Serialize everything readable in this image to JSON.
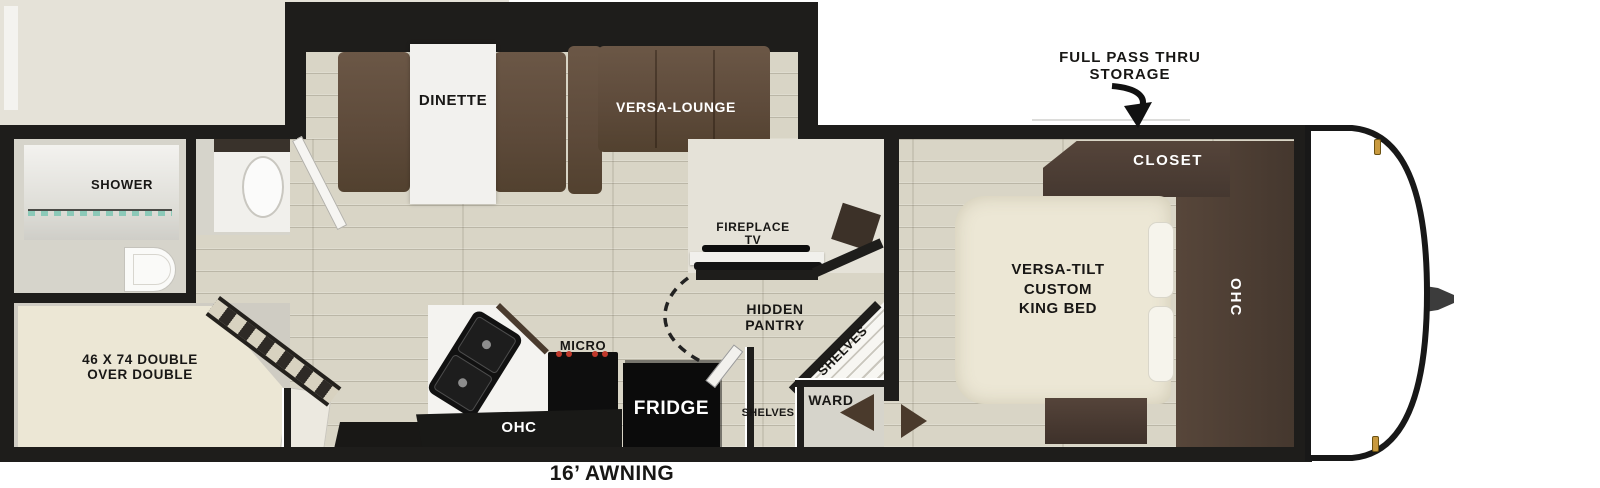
{
  "exterior": {
    "storage_callout_line1": "FULL PASS THRU",
    "storage_callout_line2": "STORAGE",
    "awning": "16’ AWNING"
  },
  "slideout": {
    "dinette": "DINETTE",
    "lounge": "VERSA-LOUNGE"
  },
  "living": {
    "fireplace_line1": "FIREPLACE",
    "fireplace_line2": "TV",
    "pantry_line1": "HIDDEN",
    "pantry_line2": "PANTRY",
    "corner_shelves": "SHELVES",
    "aisle_shelves": "SHELVES",
    "ward": "WARD"
  },
  "kitchen": {
    "micro": "MICRO",
    "fridge": "FRIDGE",
    "ohc": "OHC"
  },
  "bath": {
    "shower": "SHOWER"
  },
  "bunk": {
    "line1": "46 X 74 DOUBLE",
    "line2": "OVER DOUBLE"
  },
  "bedroom": {
    "closet": "CLOSET",
    "bed_line1": "VERSA-TILT",
    "bed_line2": "CUSTOM",
    "bed_line3": "KING BED",
    "ohc": "OHC"
  },
  "colors": {
    "wall": "#1e1d1b",
    "floor": "#d9d5c6",
    "sofa_brown": "#5d4a3a",
    "cabinet_brown": "#4b3c33",
    "bed_cream": "#ece7d5",
    "burner_red": "#c0392b",
    "clearance_light_amber": "#c99a3f",
    "shower_glass_teal": "#8cc9b8"
  }
}
